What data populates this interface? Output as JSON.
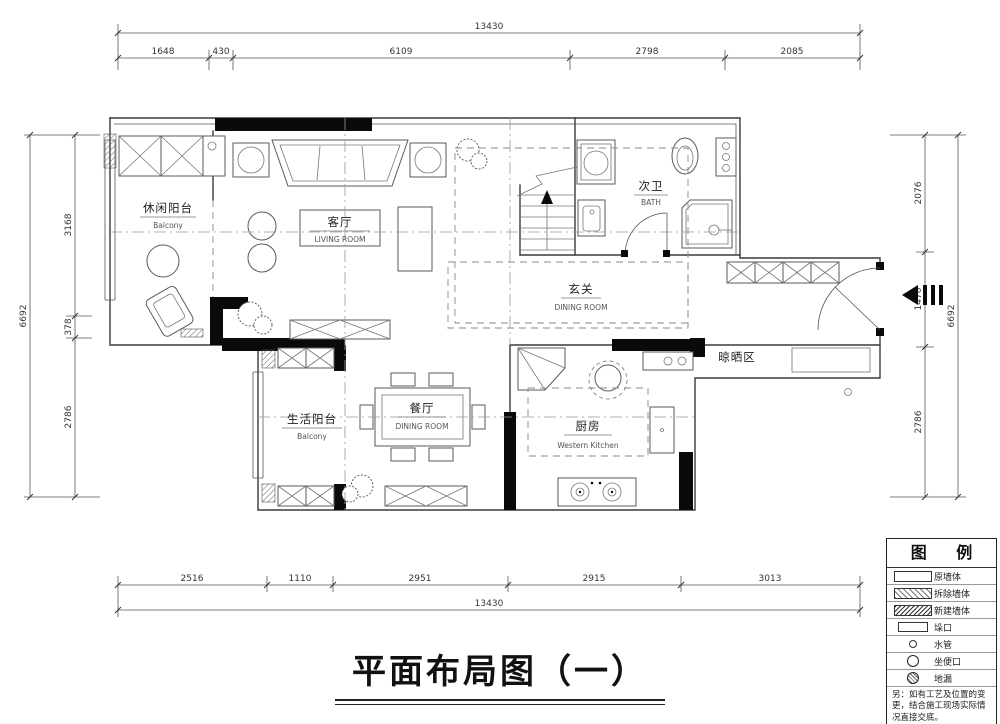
{
  "title": {
    "text": "平面布局图（一）"
  },
  "dimensions": {
    "top": {
      "overall": "13430",
      "segments": [
        "1648",
        "430",
        "6109",
        "2798",
        "2085"
      ]
    },
    "bottom": {
      "overall": "13430",
      "segments": [
        "2516",
        "1110",
        "2951",
        "2915",
        "3013"
      ]
    },
    "left": {
      "overall": "6692",
      "segments": [
        "3168",
        "378",
        "2786"
      ]
    },
    "right": {
      "overall": "6692",
      "segments": [
        "2076",
        "1470",
        "2786"
      ]
    }
  },
  "rooms": {
    "leisure_balcony": {
      "name": "休闲阳台",
      "en": "Balcony"
    },
    "living": {
      "name": "客厅",
      "en": "LIVING ROOM"
    },
    "bath": {
      "name": "次卫",
      "en": "BATH"
    },
    "entry": {
      "name": "玄关",
      "en": "DINING ROOM"
    },
    "drying": {
      "name": "晾晒区"
    },
    "life_balcony": {
      "name": "生活阳台",
      "en": "Balcony"
    },
    "dining": {
      "name": "餐厅",
      "en": "DINING ROOM"
    },
    "kitchen": {
      "name": "厨房",
      "en": "Western Kitchen"
    }
  },
  "legend": {
    "title": "图 例",
    "items": [
      {
        "symbol": "original-wall-swatch",
        "label": "原墙体"
      },
      {
        "symbol": "demolish-wall-swatch",
        "label": "拆除墙体"
      },
      {
        "symbol": "new-wall-swatch",
        "label": "新建墙体"
      },
      {
        "symbol": "opening-swatch",
        "label": "垛口"
      },
      {
        "symbol": "water-pipe-symbol",
        "label": "水管"
      },
      {
        "symbol": "toilet-outlet-symbol",
        "label": "坐便口"
      },
      {
        "symbol": "floor-drain-symbol",
        "label": "地漏"
      }
    ],
    "note": "另：如有工艺及位置的变更，结合施工现场实际情况直接交底。"
  },
  "colors": {
    "line": "#3a3a3a",
    "wall": "#0a0a0a",
    "background": "#ffffff"
  }
}
